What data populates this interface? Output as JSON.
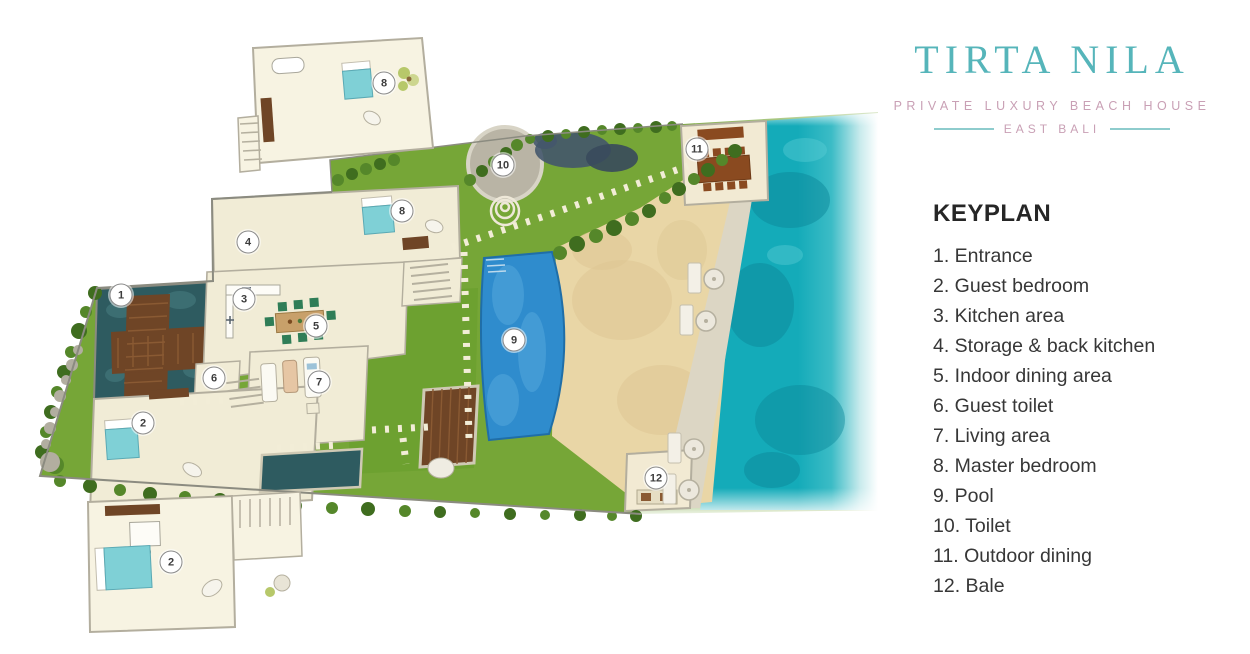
{
  "brand": {
    "title": "TIRTA NILA",
    "subtitle": "PRIVATE LUXURY BEACH HOUSE",
    "location": "EAST BALI"
  },
  "keyplan": {
    "heading": "KEYPLAN",
    "items": [
      {
        "n": "1",
        "label": "Entrance"
      },
      {
        "n": "2",
        "label": "Guest bedroom"
      },
      {
        "n": "3",
        "label": "Kitchen area"
      },
      {
        "n": "4",
        "label": "Storage & back kitchen"
      },
      {
        "n": "5",
        "label": "Indoor dining area"
      },
      {
        "n": "6",
        "label": "Guest toilet"
      },
      {
        "n": "7",
        "label": "Living area"
      },
      {
        "n": "8",
        "label": "Master bedroom"
      },
      {
        "n": "9",
        "label": "Pool"
      },
      {
        "n": "10",
        "label": "Toilet"
      },
      {
        "n": "11",
        "label": "Outdoor dining"
      },
      {
        "n": "12",
        "label": "Bale"
      }
    ]
  },
  "plan": {
    "markers": [
      {
        "n": "1",
        "x": 121,
        "y": 295,
        "area": "entrance"
      },
      {
        "n": "2",
        "x": 143,
        "y": 423,
        "area": "guest-bedroom"
      },
      {
        "n": "3",
        "x": 244,
        "y": 299,
        "area": "kitchen"
      },
      {
        "n": "4",
        "x": 248,
        "y": 242,
        "area": "storage-back-kitchen"
      },
      {
        "n": "5",
        "x": 316,
        "y": 326,
        "area": "indoor-dining"
      },
      {
        "n": "6",
        "x": 214,
        "y": 378,
        "area": "guest-toilet"
      },
      {
        "n": "7",
        "x": 319,
        "y": 382,
        "area": "living"
      },
      {
        "n": "8",
        "x": 402,
        "y": 211,
        "area": "master-bedroom"
      },
      {
        "n": "9",
        "x": 514,
        "y": 340,
        "area": "pool"
      },
      {
        "n": "10",
        "x": 503,
        "y": 165,
        "area": "toilet"
      },
      {
        "n": "11",
        "x": 697,
        "y": 149,
        "area": "outdoor-dining"
      },
      {
        "n": "12",
        "x": 656,
        "y": 478,
        "area": "bale"
      },
      {
        "n": "8",
        "x": 384,
        "y": 83,
        "area": "master-bedroom-upper-inset"
      },
      {
        "n": "2",
        "x": 171,
        "y": 562,
        "area": "guest-bedroom-lower-inset"
      }
    ]
  },
  "colors": {
    "logo_teal": "#56b5ba",
    "logo_pink": "#c9a0b5",
    "rule_teal": "#8ecccd",
    "lawn": "#76a637",
    "sand": "#e9d6a6",
    "ocean": "#14abb9",
    "pool": "#2f8ccd",
    "pond": "#2e5b60",
    "floor_cream": "#f1ecd6",
    "wood_brown": "#6f4526",
    "text_dark": "#373737"
  }
}
